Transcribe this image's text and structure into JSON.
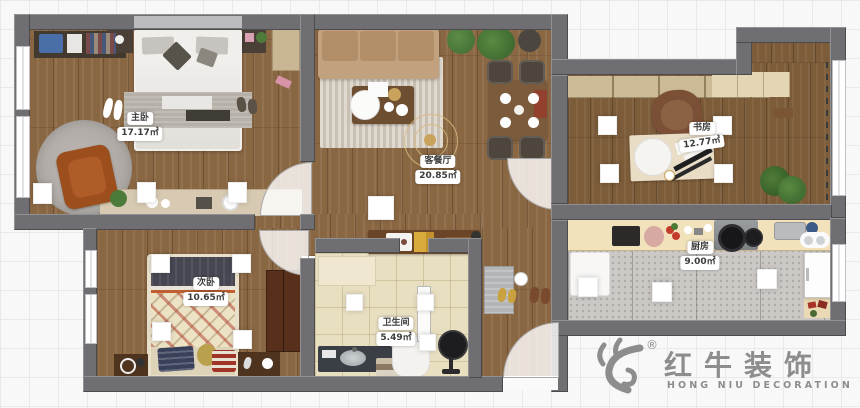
{
  "plan": {
    "rooms": [
      {
        "name": "主卧",
        "area": "17.17㎡"
      },
      {
        "name": "客餐厅",
        "area": "20.85㎡"
      },
      {
        "name": "书房",
        "area": "12.77㎡"
      },
      {
        "name": "次卧",
        "area": "10.65㎡"
      },
      {
        "name": "卫生间",
        "area": "5.49㎡"
      },
      {
        "name": "厨房",
        "area": "9.00㎡"
      }
    ]
  },
  "logo": {
    "registered": "®",
    "brand": "红牛装饰",
    "subtitle": "HONG NIU DECORATION"
  },
  "colors": {
    "wall": "#6f6f73",
    "wood_floor": "#8a6743",
    "bath_tile": "#e8dec0",
    "kitchen_tile": "#cbc8c5",
    "label_text": "#3b3b3b",
    "logo_gray": "#8d8d8d"
  }
}
